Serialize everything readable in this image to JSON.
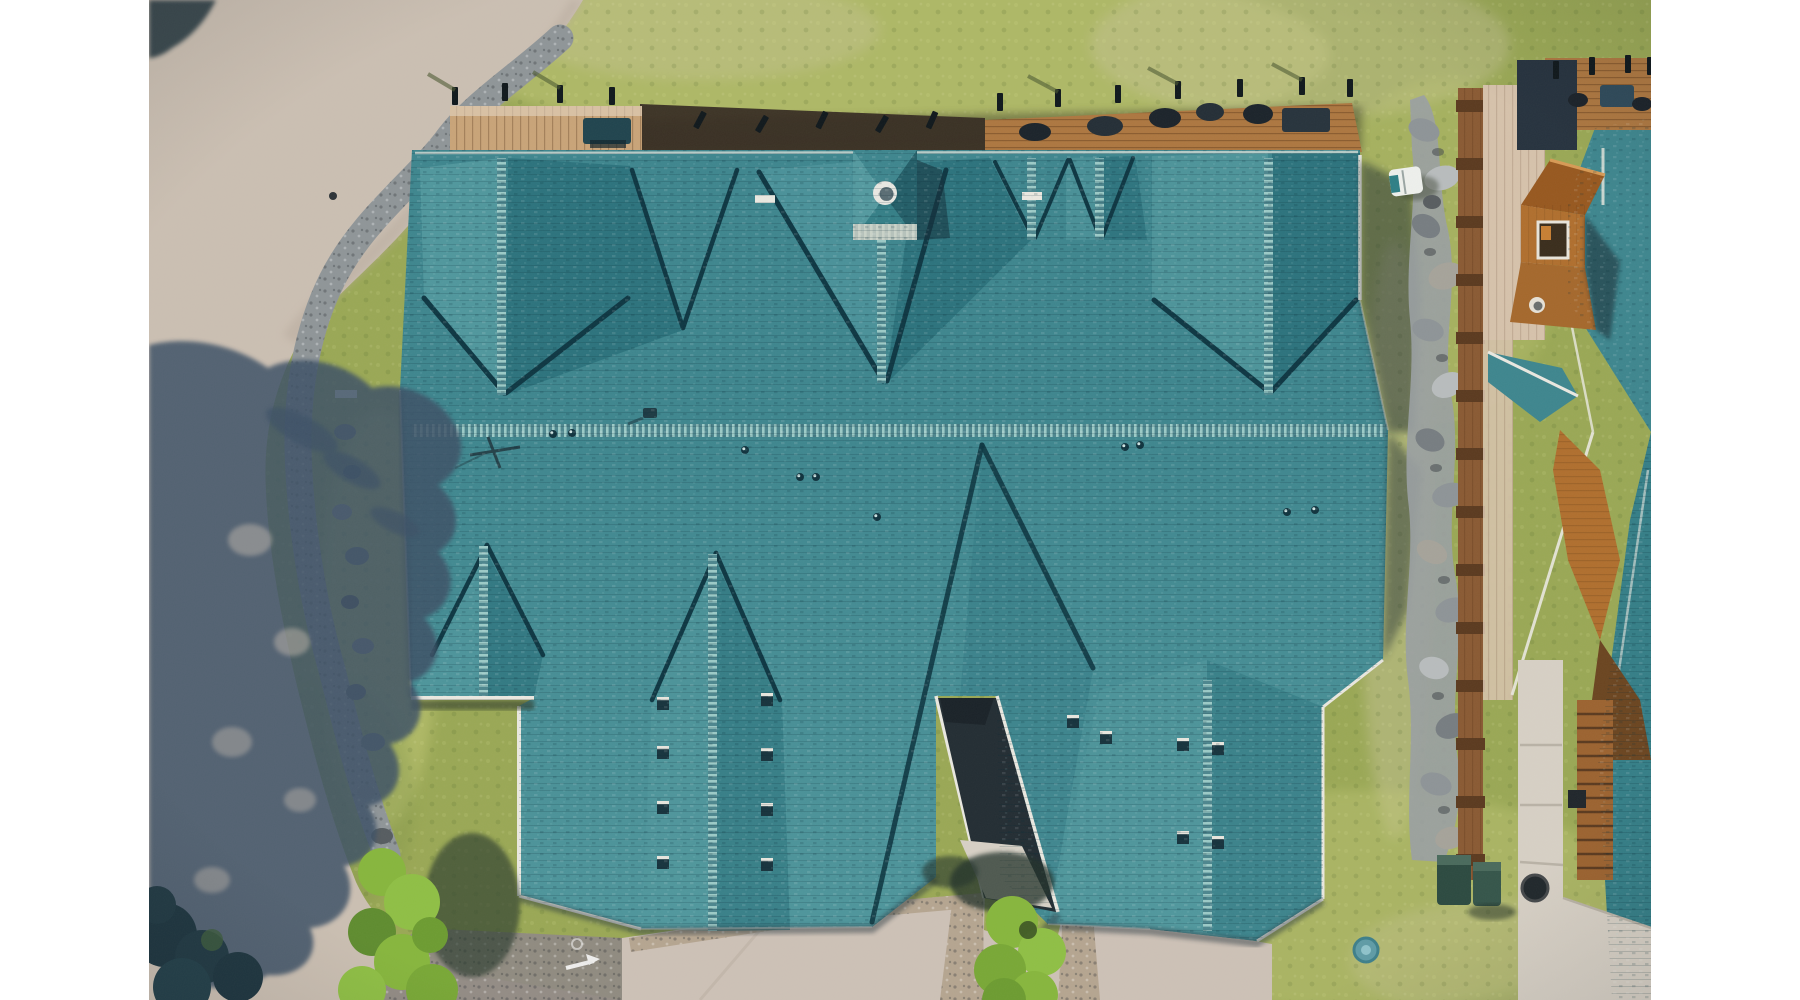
{
  "image": {
    "type": "aerial-drone-photograph",
    "subject": "top-down view of a large teal-shingle-roofed lodge complex with decks, gravel paths, a road with tree shadows, and a neighboring timber cabin",
    "photo_area": {
      "x": 149,
      "y": 0,
      "width": 1502,
      "height": 1000
    },
    "description": "Top-down aerial photo: white letterbox margins left and right; tan road with large tree shadow on the left; curving gravel footpath; green lawn; huge teal shingled roof with gabled sections, a central cupola with round vent, roof vents; wooden decks with furniture along the top; rock riprap border and timber boardwalk on the right; neighboring cabin with orange dormer window, concrete walkway, stairs, trash bins, fire-pit ring; bright green bushes and trees at the bottom; paved parking at bottom center with painted arrow."
  },
  "palette": {
    "white": "#ffffff",
    "grass": "#9aa855",
    "grassLight": "#c2c878",
    "grassDry": "#c8c49a",
    "grassDark": "#7f9349",
    "road": "#cbbfb2",
    "asphalt": "#8f8983",
    "pavement": "#cdc1b6",
    "gravelBand": "#b2a28c",
    "concrete": "#d7d0c5",
    "pathGravel": "#8f9598",
    "rock": "#9aa0a3",
    "mulch": "#362c22",
    "shadowBand": "#4a4a2e",
    "deckLight": "#c9a478",
    "deckMid": "#ad7740",
    "fenceWood": "#8a5a33",
    "paleWood": "#d6c2ab",
    "neighborWood": "#b06f2e",
    "woodDark": "#6b4520",
    "roofBase": "#3e868e",
    "roofLight": "#549aa0",
    "roofDark": "#2c737d",
    "roofDeep": "#235e68",
    "valley": "#0e3743",
    "eave": "#eae8e0",
    "cupolaTrim": "#d9d6ca",
    "treeShadow": "#3d5166",
    "foliageDark": "#21343c",
    "bushGreen": "#87b63d",
    "bushDark": "#5f8c2f",
    "navyRoof": "#26323e",
    "dormer": "#b06f2e",
    "dormerDark": "#97581f",
    "binGreen": "#2c4a40",
    "blueCap": "#5f9ba6",
    "cartWhite": "#eef0ec",
    "buildingShadow": "#1c2a33"
  },
  "scene": {
    "objects": [
      {
        "name": "road",
        "label": "tan asphalt road along left side"
      },
      {
        "name": "tree-shadow",
        "label": "large tree shadow cast across road"
      },
      {
        "name": "gravel-path",
        "label": "curving gravel footpath with boulders"
      },
      {
        "name": "lawn",
        "label": "mottled green lawn"
      },
      {
        "name": "main-roof",
        "label": "teal shingled lodge roof with gables and valleys"
      },
      {
        "name": "cupola",
        "label": "central roof cupola with round vent and white trim"
      },
      {
        "name": "decks",
        "label": "wooden decks with railings and patio furniture"
      },
      {
        "name": "rock-border",
        "label": "boulder riprap strip"
      },
      {
        "name": "boardwalk",
        "label": "timber boardwalk and fence"
      },
      {
        "name": "neighbor-building",
        "label": "neighboring cabin with orange dormer and window"
      },
      {
        "name": "golf-cart",
        "label": "white golf cart on grass"
      },
      {
        "name": "concrete-walkway",
        "label": "concrete walkway with seams"
      },
      {
        "name": "stairs",
        "label": "wooden stairs"
      },
      {
        "name": "trash-bins",
        "label": "green refuse bins"
      },
      {
        "name": "fire-pit",
        "label": "dark fire-pit ring"
      },
      {
        "name": "utility-cover",
        "label": "round blue utility cover"
      },
      {
        "name": "bushes",
        "label": "bright green shrubs"
      },
      {
        "name": "pavement",
        "label": "paved parking with painted arrow"
      }
    ]
  }
}
